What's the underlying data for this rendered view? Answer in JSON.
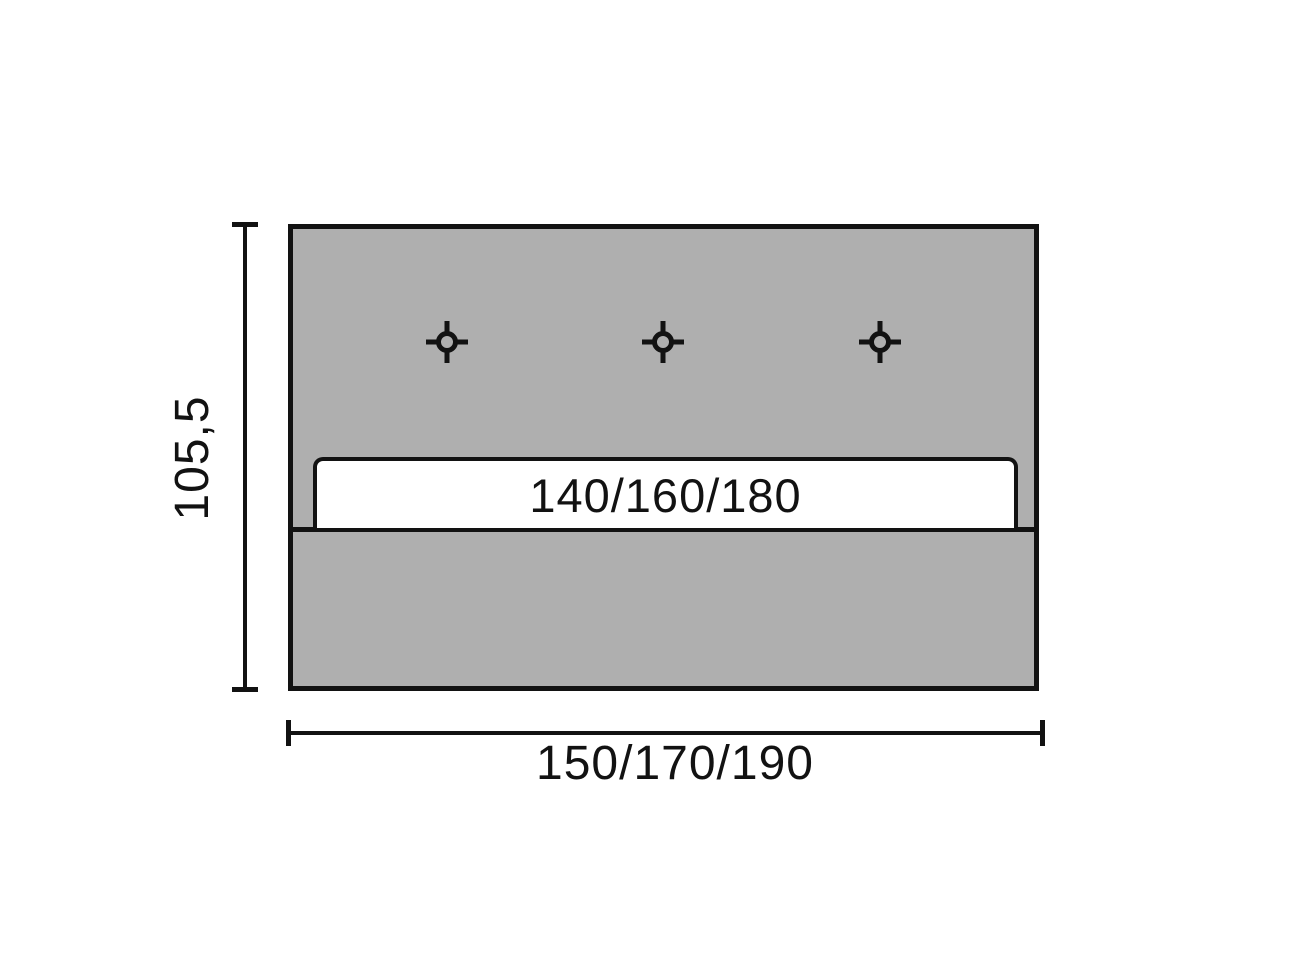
{
  "colors": {
    "background": "#ffffff",
    "panel_fill": "#afafaf",
    "line": "#121212",
    "slot_fill": "#ffffff"
  },
  "diagram": {
    "type": "dimensioned-technical-drawing",
    "height_dimension": "105,5",
    "width_dimension": "150/170/190",
    "slot_dimension": "140/160/180",
    "marker_icon": "crosshair-drill-marker",
    "marker_count": 3
  }
}
